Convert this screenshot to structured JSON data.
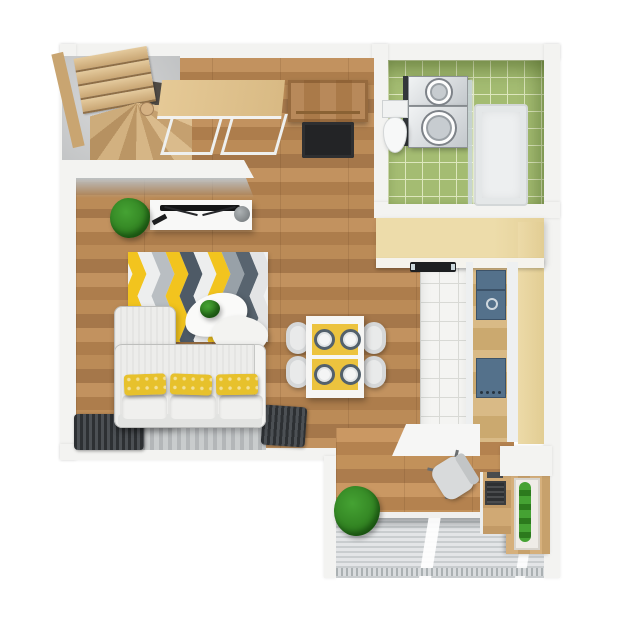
{
  "scene": {
    "type": "apartment-floor-plan-3d-top-view",
    "rooms": [
      {
        "id": "living-room",
        "furniture": [
          "staircase",
          "console-table",
          "tv-stand",
          "tv",
          "speaker",
          "potted-plant",
          "chevron-rug",
          "coffee-tables",
          "sofa",
          "window-curtains",
          "gray-floor-rug"
        ],
        "coffee_tables": 2,
        "sofa_pillows": 3
      },
      {
        "id": "dining-area",
        "furniture": [
          "dining-table",
          "chairs",
          "placemats",
          "plates"
        ],
        "chairs": 4,
        "placemats": 2,
        "plates": 4
      },
      {
        "id": "hallway",
        "furniture": [
          "entry-door",
          "doormat"
        ]
      },
      {
        "id": "bathroom",
        "furniture": [
          "washer-dryer-stack",
          "toilet",
          "shower-enclosure"
        ],
        "stacked_appliances": 2
      },
      {
        "id": "kitchen",
        "furniture": [
          "l-shaped-counter",
          "black-cooktop",
          "sink",
          "hob",
          "white-tile-floor"
        ],
        "hob_knobs": 4
      },
      {
        "id": "workspace",
        "furniture": [
          "white-cabinet",
          "office-chair",
          "desk",
          "keyboard",
          "vertical-planter"
        ]
      },
      {
        "id": "balcony",
        "furniture": [
          "wood-decking",
          "bush",
          "railing"
        ]
      }
    ]
  },
  "palette": {
    "wall": "#f3f3f1",
    "wallFace": "#bcc0c2",
    "woodMid": "#b9885a",
    "stairWood": "#dcbf92",
    "counterPale": "#eddcaa",
    "doorWood": "#b8895a",
    "doorWoodDark": "#9a6f3e",
    "tileGreen": "#a4bc72",
    "tileGroutGreen": "#dde7bd",
    "kitchenTile": "#f4f4f2",
    "kitchenTileGrout": "#d8d9d5",
    "applianceNavy": "#54718b",
    "black": "#1d1f21",
    "matBlack": "#232426",
    "consoleWhite": "#f8f8f7",
    "sofaWhite": "#ededeb",
    "pillowYellow": "#e7c12c",
    "rugYellow": "#ecc33e",
    "curtainDark": "#2d3033",
    "deckLine": "#c9cdcf",
    "railGray": "#aab0b2",
    "plantGreen": "#45a233",
    "plantDark": "#2c7a1d",
    "glassBlue": "#ccd8dc"
  },
  "rug": {
    "name": "chevron-rug",
    "stripe_colors": [
      "#f2c41e",
      "#edeeee",
      "#b9bec2",
      "#f2c41e",
      "#4e5a66",
      "#edeeee",
      "#f2c41e",
      "#98a1a8",
      "#58646f",
      "#e3e4e5"
    ]
  }
}
